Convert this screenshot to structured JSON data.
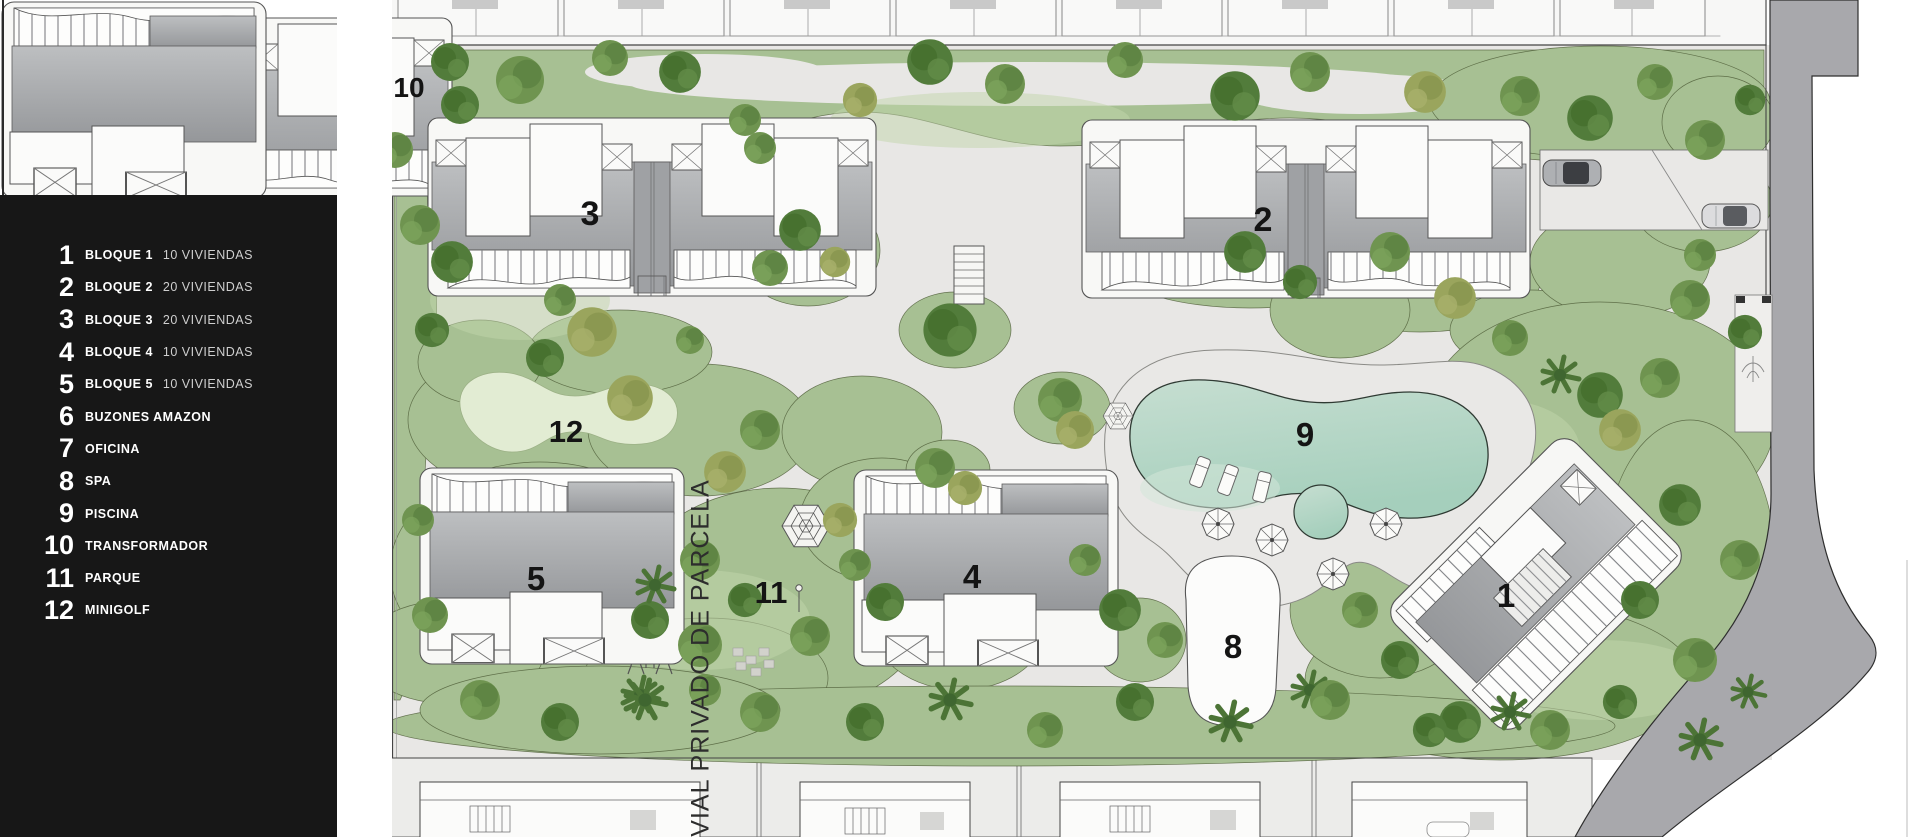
{
  "page": {
    "background": "#ffffff"
  },
  "legend": {
    "items": [
      {
        "num": "1",
        "label": "BLOQUE 1",
        "sub": "10 VIVIENDAS"
      },
      {
        "num": "2",
        "label": "BLOQUE 2",
        "sub": "20 VIVIENDAS"
      },
      {
        "num": "3",
        "label": "BLOQUE 3",
        "sub": "20 VIVIENDAS"
      },
      {
        "num": "4",
        "label": "BLOQUE 4",
        "sub": "10 VIVIENDAS"
      },
      {
        "num": "5",
        "label": "BLOQUE 5",
        "sub": "10 VIVIENDAS"
      },
      {
        "num": "6",
        "label": "BUZONES AMAZON",
        "sub": ""
      },
      {
        "num": "7",
        "label": "OFICINA",
        "sub": ""
      },
      {
        "num": "8",
        "label": "SPA",
        "sub": ""
      },
      {
        "num": "9",
        "label": "PISCINA",
        "sub": ""
      },
      {
        "num": "10",
        "label": "TRANSFORMADOR",
        "sub": ""
      },
      {
        "num": "11",
        "label": "PARQUE",
        "sub": ""
      },
      {
        "num": "12",
        "label": "MINIGOLF",
        "sub": ""
      }
    ]
  },
  "street_label": "VIAL PRIVADO DE PARCELA",
  "plan_labels": {
    "b1": "1",
    "b2": "2",
    "b3": "3",
    "b4": "4",
    "b5": "5",
    "spa": "8",
    "pool": "9",
    "transformer": "10",
    "park": "11",
    "minigolf": "12"
  },
  "colors": {
    "legend_bg": "#171717",
    "paving": "#e8e7e5",
    "grass": "#a7c093",
    "pool_water": "#b2d6c4",
    "minigolf_green": "#e2ecd3",
    "road_dark": "#a8a8ac",
    "roof_gray": "#a6a8ab",
    "label_ink": "#141414"
  }
}
